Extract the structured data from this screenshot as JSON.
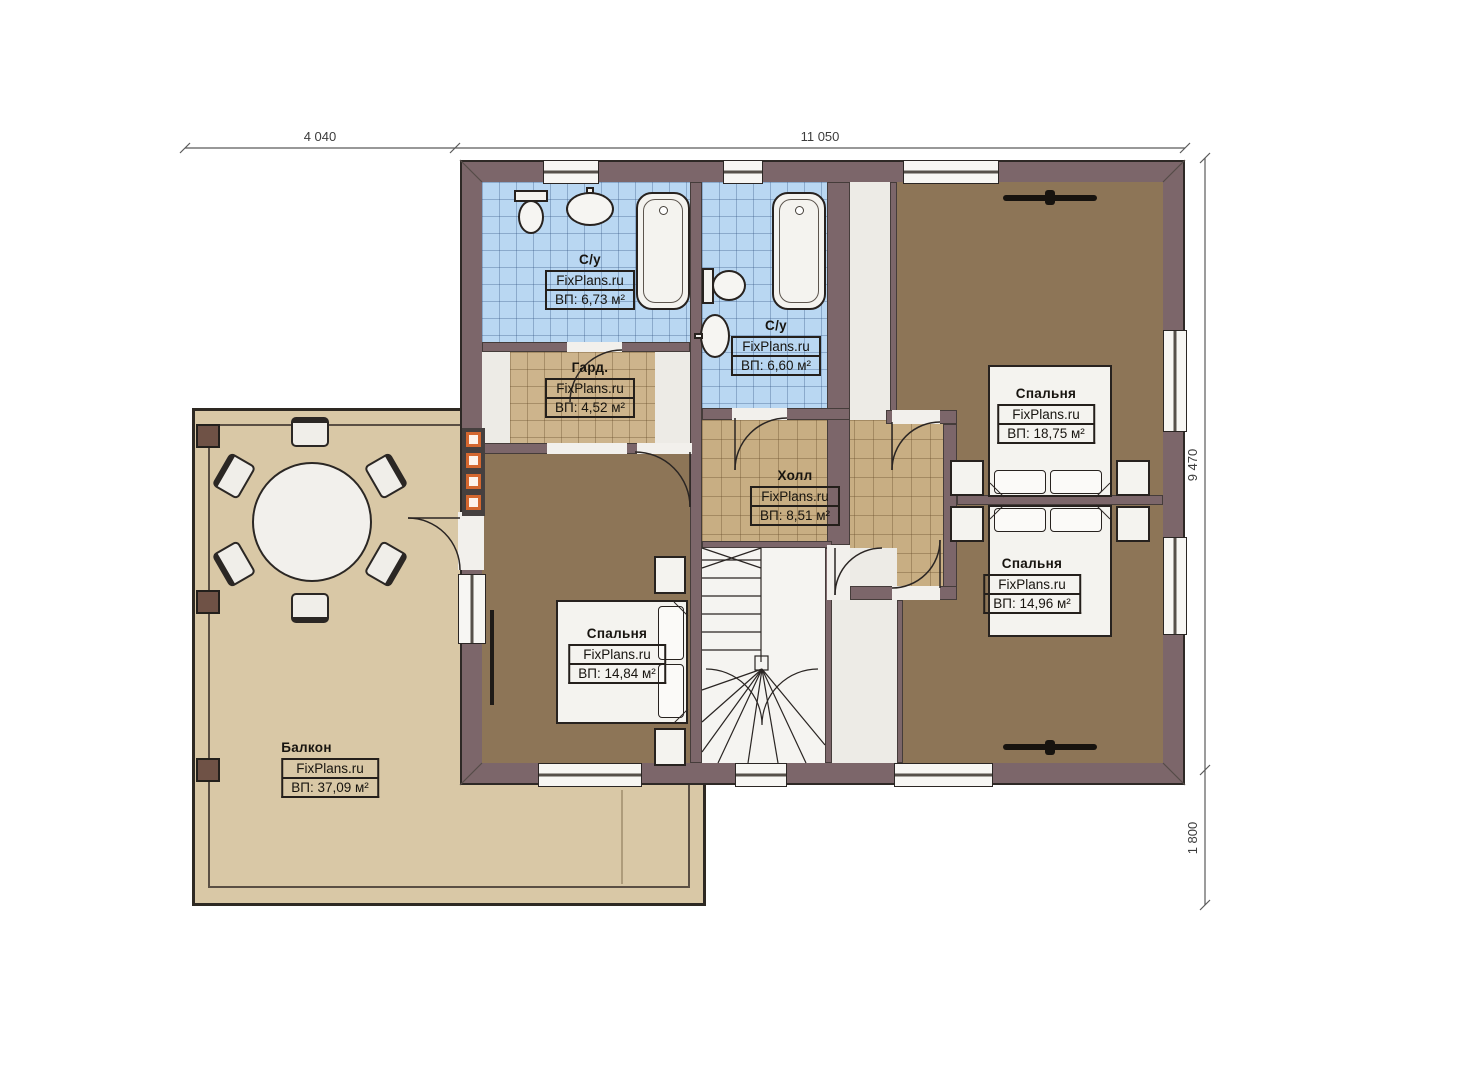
{
  "dimensions": {
    "top_left": "4 040",
    "top_right": "11 050",
    "right_upper": "9 470",
    "right_lower": "1 800"
  },
  "rooms": [
    {
      "id": "bathroom-top",
      "name": "С/у",
      "watermark": "FixPlans.ru",
      "area": "ВП: 6,73 м²"
    },
    {
      "id": "bathroom-middle",
      "name": "С/у",
      "watermark": "FixPlans.ru",
      "area": "ВП: 6,60 м²"
    },
    {
      "id": "wardrobe",
      "name": "Гард.",
      "watermark": "FixPlans.ru",
      "area": "ВП: 4,52 м²"
    },
    {
      "id": "hall",
      "name": "Холл",
      "watermark": "FixPlans.ru",
      "area": "ВП: 8,51 м²"
    },
    {
      "id": "bedroom-top-right",
      "name": "Спальня",
      "watermark": "FixPlans.ru",
      "area": "ВП: 18,75 м²"
    },
    {
      "id": "bedroom-bottom-right",
      "name": "Спальня",
      "watermark": "FixPlans.ru",
      "area": "ВП: 14,96 м²"
    },
    {
      "id": "bedroom-left",
      "name": "Спальня",
      "watermark": "FixPlans.ru",
      "area": "ВП: 14,84 м²"
    },
    {
      "id": "balcony",
      "name": "Балкон",
      "watermark": "FixPlans.ru",
      "area": "ВП: 37,09 м²"
    }
  ],
  "colors": {
    "wall": "#7c666a",
    "bathroom_tile": "#b9d7f2",
    "wardrobe_tile": "#cdb48c",
    "hall_tile": "#c8ae83",
    "bedroom_floor": "#8d7557",
    "balcony_floor": "#d9c8a6",
    "accent_orange": "#d4672f"
  }
}
